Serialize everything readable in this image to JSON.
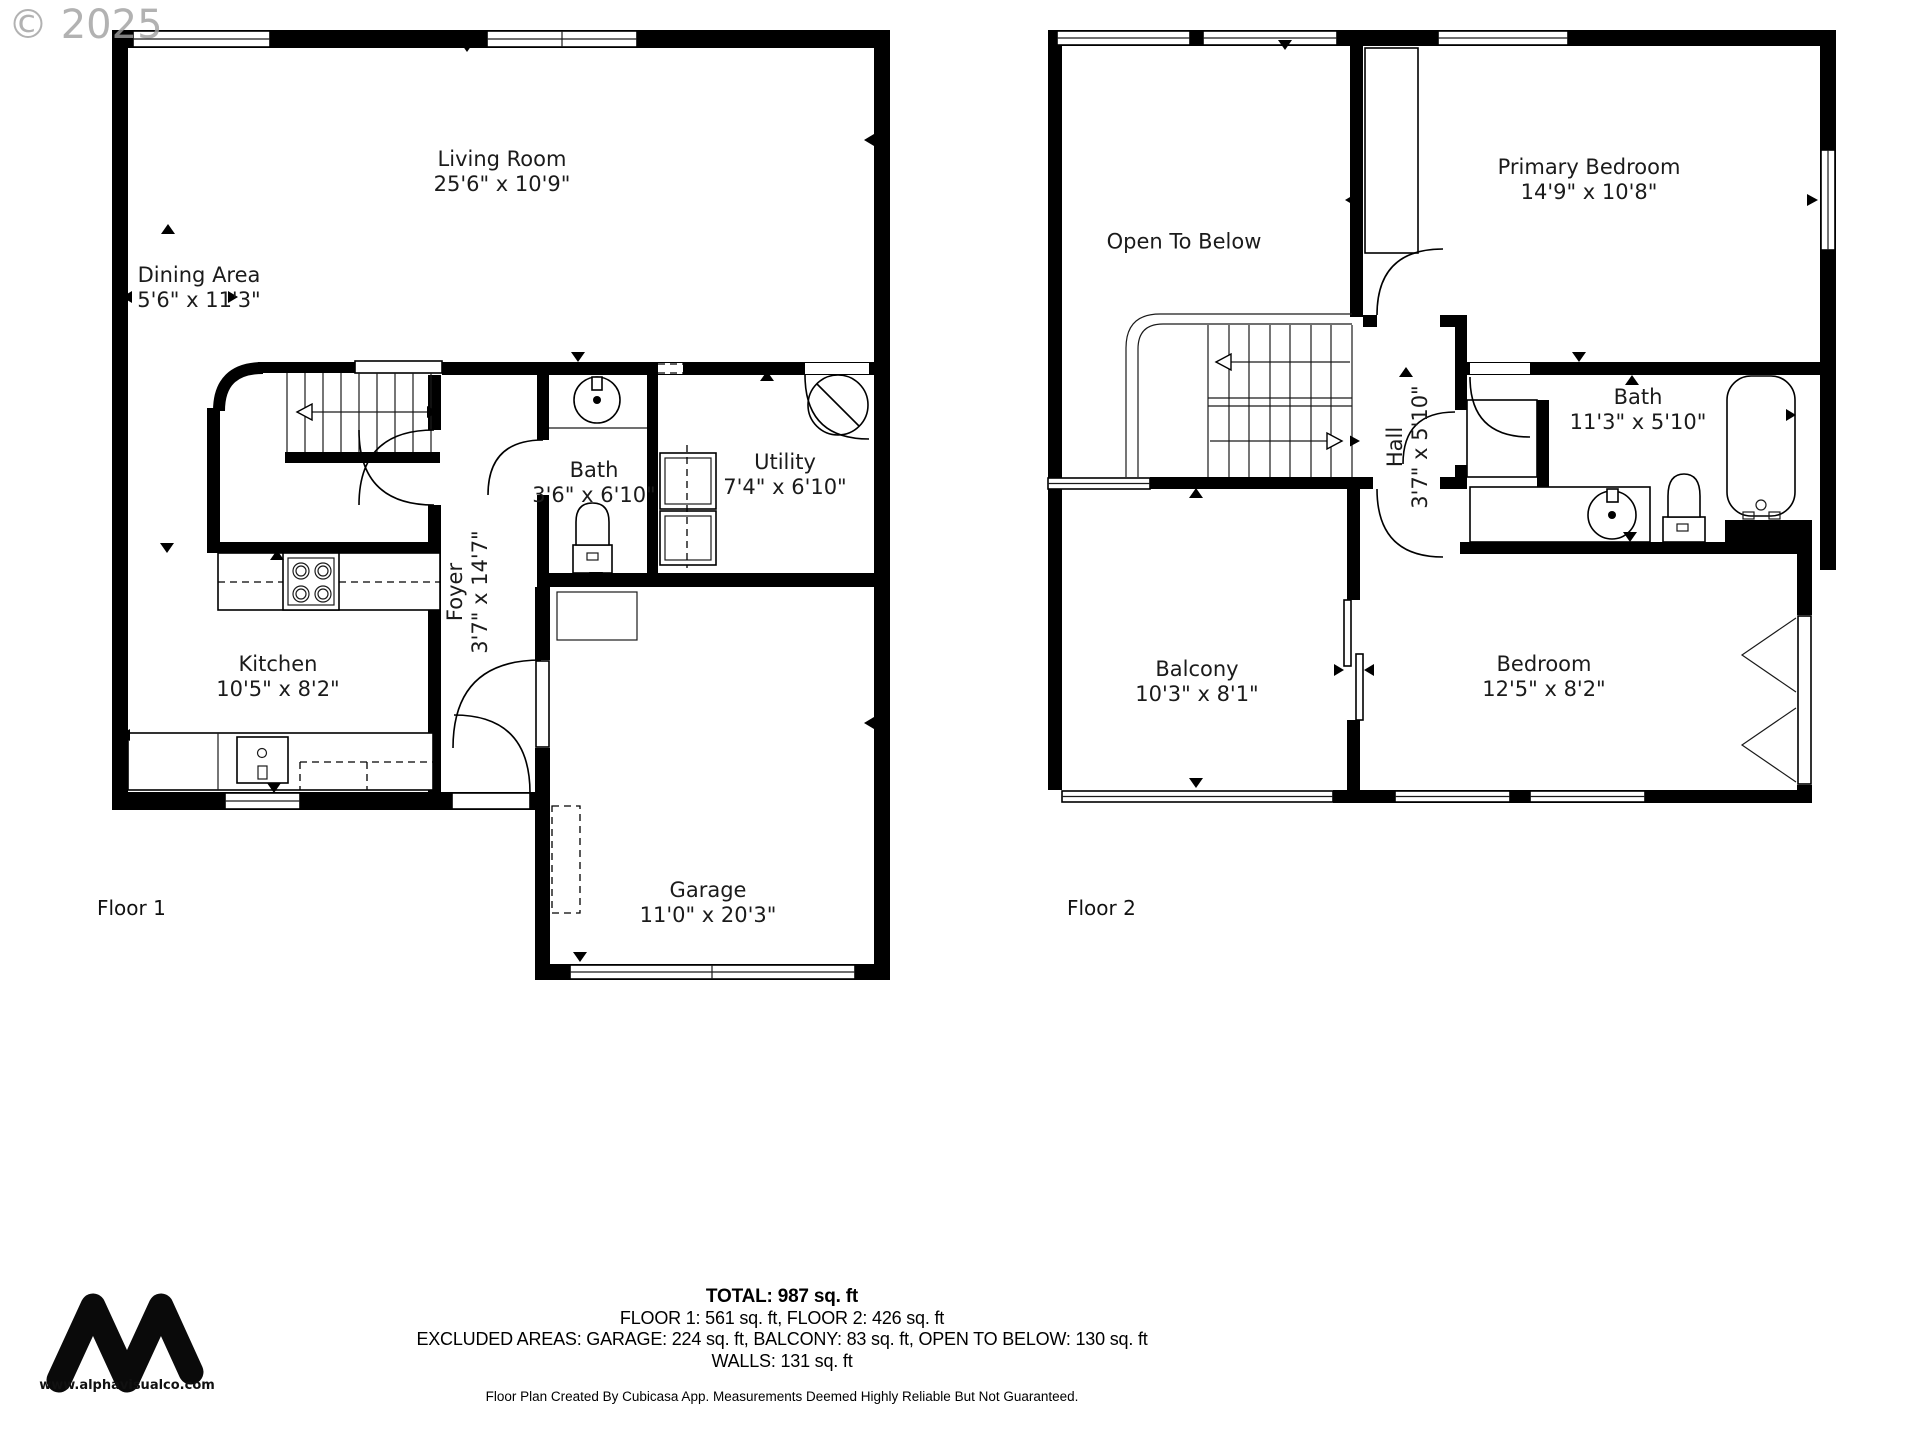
{
  "watermark": "© 2025",
  "floor1": {
    "label": "Floor 1",
    "rooms": {
      "living_room": {
        "name": "Living Room",
        "dims": "25'6\" x 10'9\""
      },
      "dining_area": {
        "name": "Dining Area",
        "dims": "5'6\" x 11'3\""
      },
      "bath": {
        "name": "Bath",
        "dims": "3'6\" x 6'10\""
      },
      "utility": {
        "name": "Utility",
        "dims": "7'4\" x 6'10\""
      },
      "foyer": {
        "name": "Foyer",
        "dims": "3'7\" x 14'7\""
      },
      "kitchen": {
        "name": "Kitchen",
        "dims": "10'5\" x 8'2\""
      },
      "garage": {
        "name": "Garage",
        "dims": "11'0\" x 20'3\""
      }
    }
  },
  "floor2": {
    "label": "Floor 2",
    "rooms": {
      "open_to_below": {
        "name": "Open To Below",
        "dims": ""
      },
      "primary_bedroom": {
        "name": "Primary Bedroom",
        "dims": "14'9\" x 10'8\""
      },
      "bath": {
        "name": "Bath",
        "dims": "11'3\" x 5'10\""
      },
      "hall": {
        "name": "Hall",
        "dims": "3'7\" x 5'10\""
      },
      "balcony": {
        "name": "Balcony",
        "dims": "10'3\" x 8'1\""
      },
      "bedroom": {
        "name": "Bedroom",
        "dims": "12'5\" x 8'2\""
      }
    }
  },
  "summary": {
    "total": "TOTAL: 987 sq. ft",
    "floors": "FLOOR 1: 561 sq. ft, FLOOR 2: 426 sq. ft",
    "excluded": "EXCLUDED AREAS: GARAGE: 224 sq. ft, BALCONY: 83 sq. ft, OPEN TO BELOW: 130 sq. ft",
    "walls": "WALLS: 131 sq. ft",
    "disclaimer": "Floor Plan Created By Cubicasa App. Measurements Deemed Highly Reliable But Not Guaranteed."
  },
  "branding": {
    "website": "www.alphavisualco.com",
    "logo": "alpha-visual-logo"
  },
  "colors": {
    "wall": "#000000",
    "text": "#1b1b1b",
    "watermark": "#a0a0a0"
  }
}
